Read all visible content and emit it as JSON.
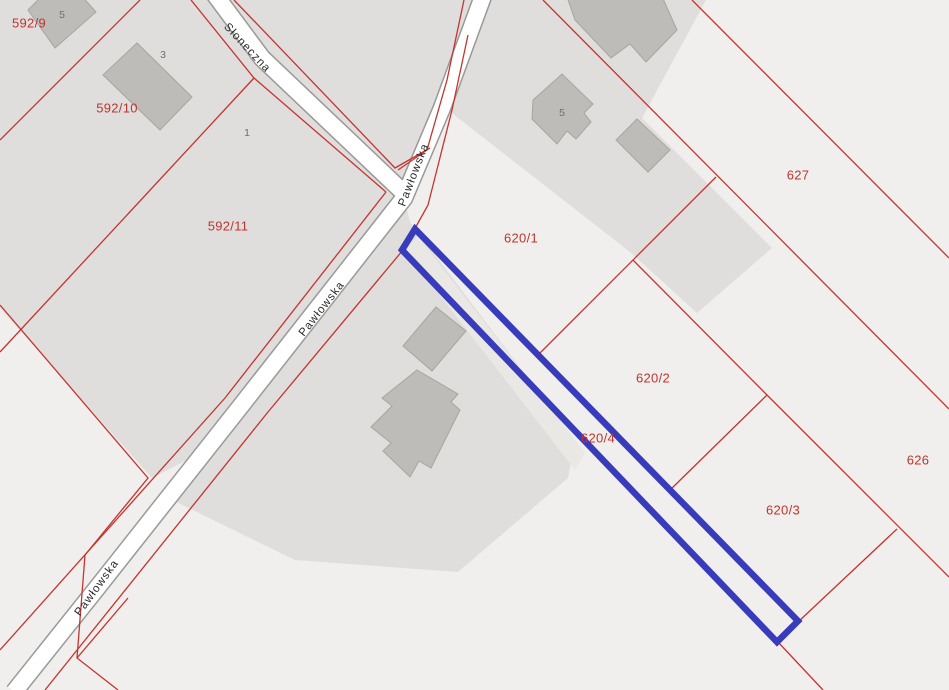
{
  "map": {
    "title": "cadastral-parcel-map",
    "highlighted_parcel": "620/4",
    "street_labels": [
      "Słoneczna",
      "Pawłowska",
      "Pawłowska",
      "Pawłowska"
    ],
    "parcel_labels": [
      "592/9",
      "592/10",
      "592/11",
      "620/1",
      "620/2",
      "620/4",
      "620/3",
      "627",
      "626"
    ],
    "house_numbers": [
      "5",
      "3",
      "1",
      "5"
    ],
    "colors": {
      "background": "#f0efed",
      "developed_fill": "#dfdedc",
      "inner_strip_fill": "#e9e8e5",
      "road_fill": "#ffffff",
      "road_casing": "#9a9998",
      "boundary_red": "#c5342f",
      "highlight_blue": "#383cba",
      "building_fill": "#bdbcb8",
      "building_stroke": "#a6a5a1",
      "parcel_text": "#c0342e",
      "house_text": "#6f6f6b",
      "street_text": "#2b2b2b"
    }
  }
}
